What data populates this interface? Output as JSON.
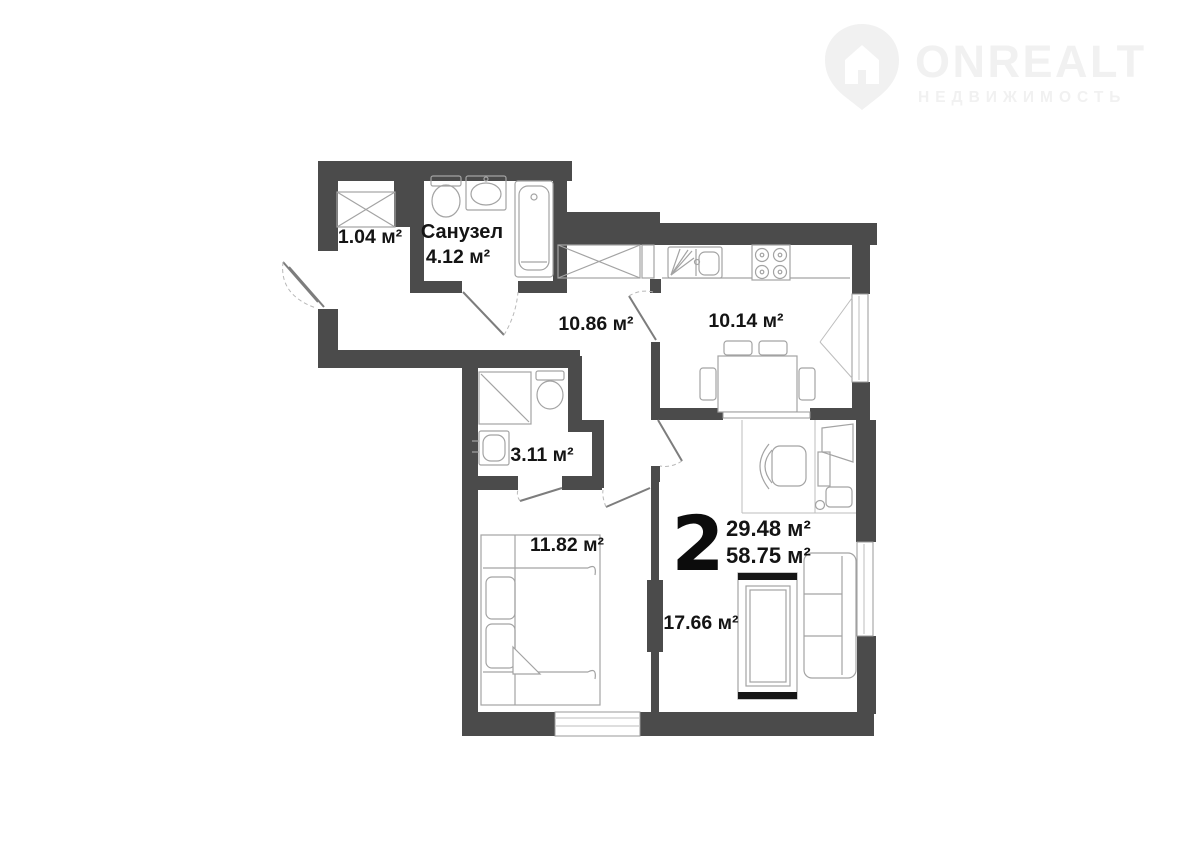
{
  "logo": {
    "brand": "ONREALT",
    "tagline": "НЕДВИЖИМОСТЬ",
    "color": "#f1f1f1"
  },
  "plan": {
    "wall_color": "#4b4b4b",
    "text_color": "#141414",
    "rooms": [
      {
        "id": "closet",
        "area_label": "1.04 м²"
      },
      {
        "id": "bathroom",
        "name": "Санузел",
        "area_label": "4.12 м²"
      },
      {
        "id": "hallway",
        "area_label": "10.86 м²"
      },
      {
        "id": "kitchen",
        "area_label": "10.14 м²"
      },
      {
        "id": "shower-room",
        "area_label": "3.11 м²"
      },
      {
        "id": "bedroom",
        "area_label": "11.82 м²"
      },
      {
        "id": "living-room",
        "area_label": "17.66 м²"
      }
    ],
    "summary": {
      "rooms_count": "2",
      "living_area": "29.48 м²",
      "total_area": "58.75 м²"
    }
  }
}
